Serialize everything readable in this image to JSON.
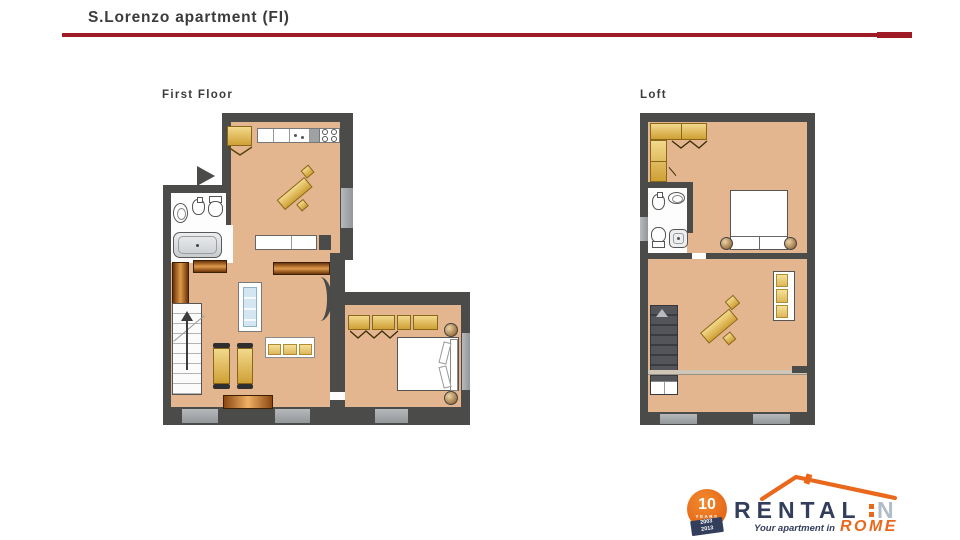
{
  "window": {
    "title": "S.Lorenzo apartment (FI)"
  },
  "plans": {
    "first_floor": {
      "label": "First Floor",
      "rooms": [
        "entry",
        "kitchen",
        "bathroom",
        "living-room",
        "bedroom"
      ],
      "furniture": [
        "wardrobe",
        "kitchen-counter",
        "sink-unit",
        "stove",
        "diagonal-dining-table",
        "washbasin",
        "bidet",
        "toilet",
        "bathtub",
        "bookshelf",
        "striped-sofa",
        "yellow-sofa",
        "chairs",
        "stairs-up",
        "sideboard",
        "double-bed",
        "bedside-lamps",
        "bedroom-wardrobe"
      ]
    },
    "loft": {
      "label": "Loft",
      "rooms": [
        "bedroom",
        "bathroom",
        "living-area"
      ],
      "furniture": [
        "corner-wardrobe",
        "bidet",
        "washbasin",
        "toilet",
        "shower",
        "double-bed",
        "bedside-lamps",
        "sofa",
        "diagonal-dining-table",
        "stairs-down",
        "railing"
      ]
    }
  },
  "logo": {
    "badge_number": "10",
    "badge_word": "YEARS",
    "year_top": "2003",
    "year_bottom": "2013",
    "brand_main": "RENTAL",
    "brand_accent": "IN",
    "brand_accent_n": "N",
    "tagline": "Your apartment in",
    "tagline_city": "ROME"
  },
  "colors": {
    "accent_red": "#9e1b26",
    "wall": "#4b4b49",
    "floor": "#e3b68f",
    "logo_navy": "#333e5c",
    "logo_orange": "#e9681c"
  }
}
